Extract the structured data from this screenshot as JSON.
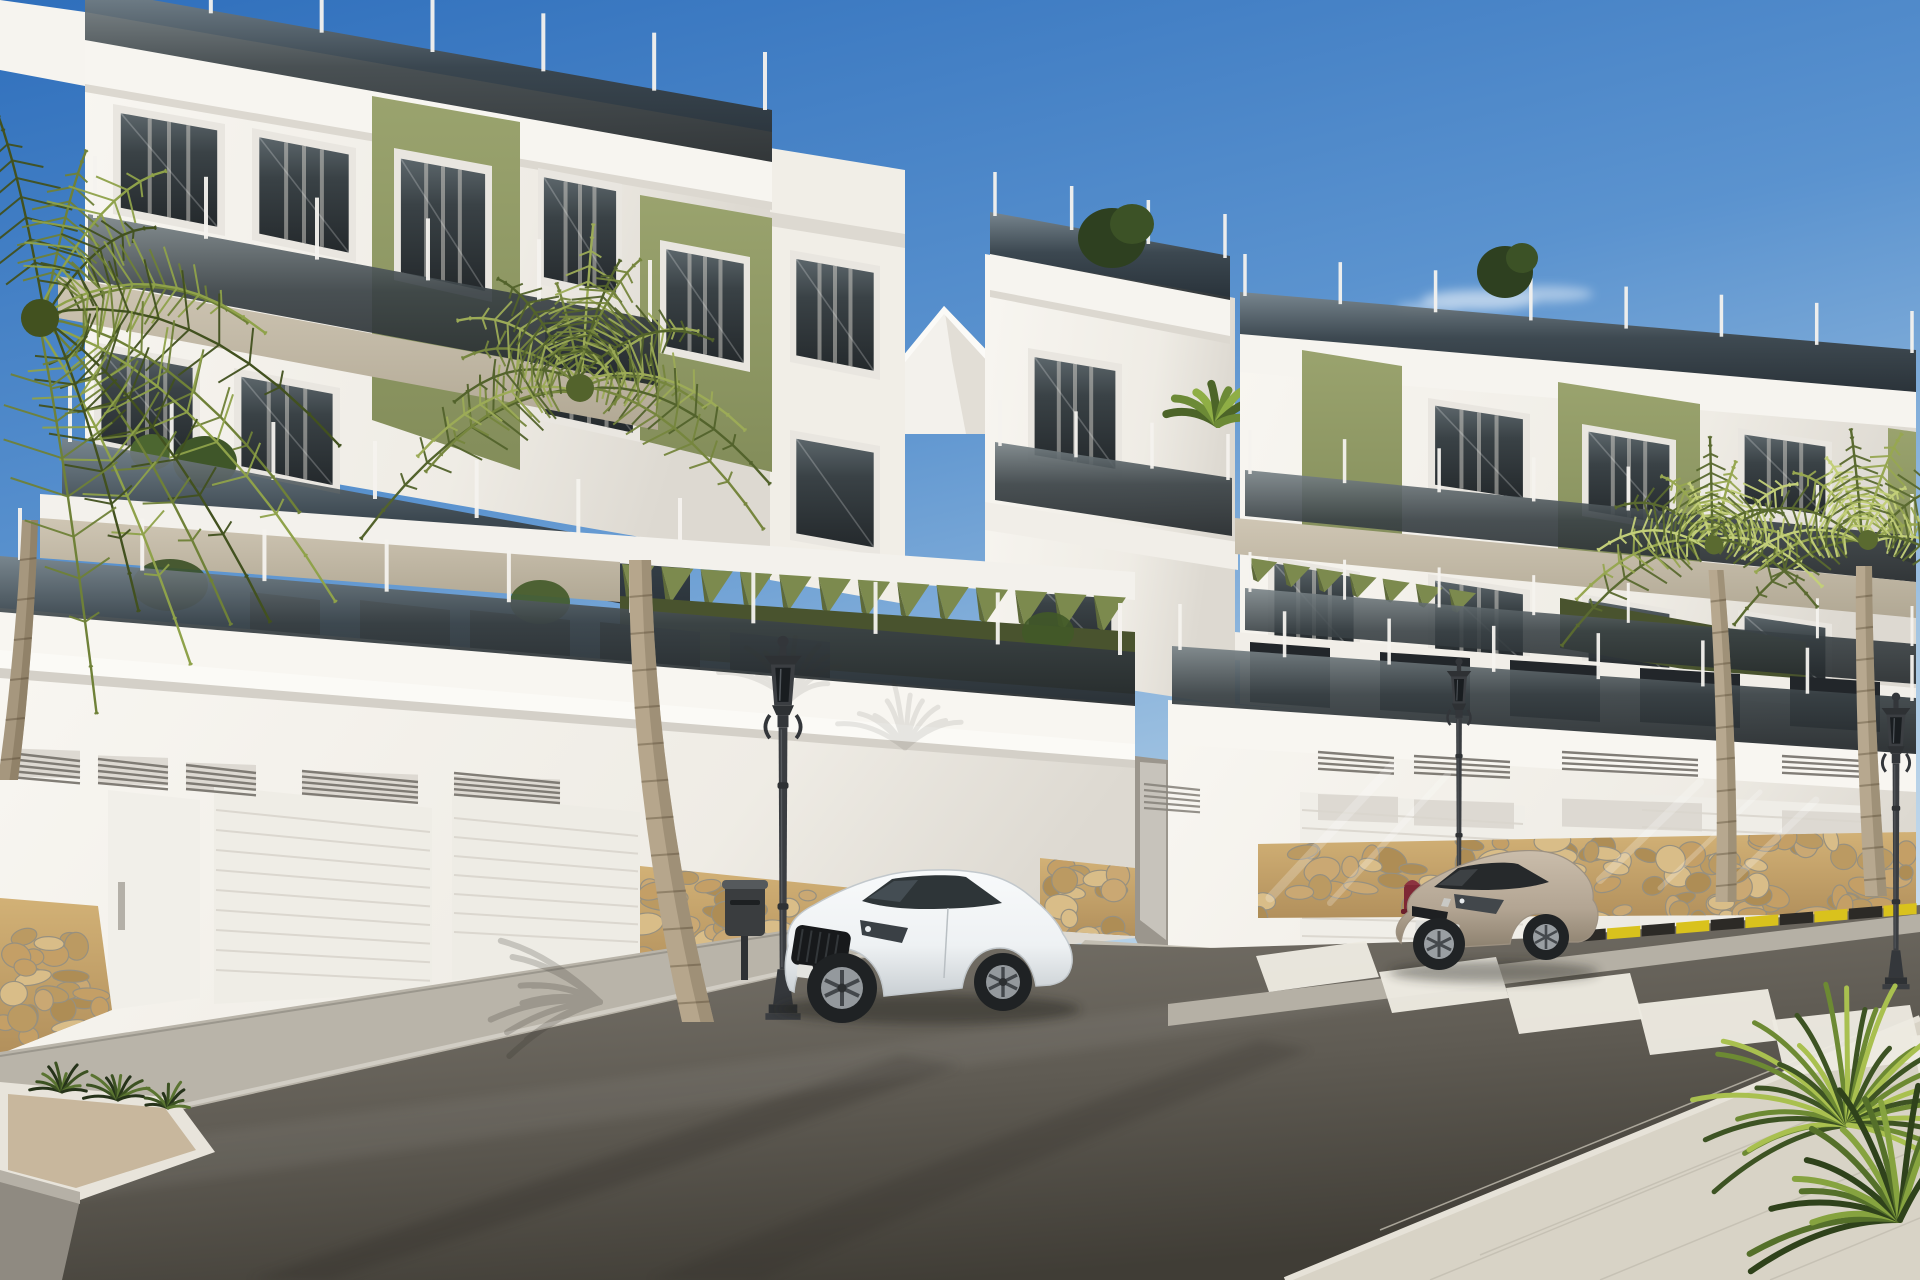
{
  "meta": {
    "scene_type": "photorealistic exterior architectural render",
    "subjects": [
      "modern apartment buildings",
      "white coupe car",
      "beige coupe car",
      "palm trees",
      "street with zebra crossing",
      "ornate street lamps",
      "fire hydrant",
      "garage doors",
      "stone base walls"
    ]
  },
  "palette": {
    "sky_top": "#2f6fbc",
    "sky_mid": "#5b93cf",
    "sky_low": "#a9c9e4",
    "sky_horizon": "#d2e2ef",
    "white_lit": "#f8f6f1",
    "white_mid": "#eceae3",
    "white_shade": "#d8d4cc",
    "taupe": "#cfc6b4",
    "taupe_dark": "#b1a894",
    "olive_lit": "#9aa36e",
    "olive": "#838d5a",
    "olive_dark": "#5f6a3c",
    "olive_deep": "#49532e",
    "glass_top": "#7b8589",
    "glass_mid": "#3a4246",
    "glass_dark": "#23282b",
    "asphalt_light": "#7d786f",
    "asphalt": "#5f5b53",
    "asphalt_dark": "#403d36",
    "sidewalk": "#b9b4a9",
    "pavers_corner": "#d8d3c6",
    "stone_bg": "#c8a76e",
    "mortar": "#97907f",
    "lamp_metal": "#35383b",
    "car_white": "#f5f7f8",
    "car_white_shade": "#c9cfd3",
    "car_beige": "#b9ab99",
    "car_beige_shade": "#8e8270",
    "hydrant_red": "#7e2835",
    "curb_yellow": "#d9c21d",
    "curb_black": "#2c2a26",
    "crosswalk_white": "#edeae1",
    "trunk": "#b6a68c",
    "trunk_shade": "#8c7d66",
    "green_dark": "#435426",
    "green_mid": "#6f8138",
    "green_lit": "#a8bb5c",
    "green_sun": "#cdd783"
  },
  "scene": {
    "windows": [
      {
        "l": "lyr-win-left",
        "pts": [
          [
            113,
            104
          ],
          [
            225,
            124
          ],
          [
            225,
            236
          ],
          [
            113,
            214
          ]
        ],
        "curt": true
      },
      {
        "l": "lyr-win-left",
        "pts": [
          [
            252,
            128
          ],
          [
            356,
            148
          ],
          [
            356,
            262
          ],
          [
            252,
            240
          ]
        ],
        "curt": true
      },
      {
        "l": "lyr-win-left",
        "pts": [
          [
            394,
            148
          ],
          [
            492,
            166
          ],
          [
            492,
            302
          ],
          [
            394,
            280
          ]
        ],
        "curt": true
      },
      {
        "l": "lyr-win-left",
        "pts": [
          [
            538,
            168
          ],
          [
            622,
            184
          ],
          [
            622,
            302
          ],
          [
            538,
            284
          ]
        ],
        "curt": true
      },
      {
        "l": "lyr-win-left",
        "pts": [
          [
            660,
            240
          ],
          [
            750,
            257
          ],
          [
            750,
            372
          ],
          [
            660,
            353
          ]
        ],
        "curt": true
      },
      {
        "l": "lyr-win-left",
        "pts": [
          [
            94,
            342
          ],
          [
            200,
            362
          ],
          [
            200,
            468
          ],
          [
            94,
            446
          ]
        ],
        "curt": true
      },
      {
        "l": "lyr-win-left",
        "pts": [
          [
            234,
            368
          ],
          [
            340,
            388
          ],
          [
            340,
            494
          ],
          [
            234,
            472
          ]
        ],
        "curt": true
      },
      {
        "l": "lyr-win-left",
        "pts": [
          [
            538,
            310
          ],
          [
            640,
            330
          ],
          [
            640,
            442
          ],
          [
            538,
            420
          ]
        ],
        "curt": true
      },
      {
        "l": "lyr-win-left",
        "pts": [
          [
            790,
            250
          ],
          [
            880,
            266
          ],
          [
            880,
            380
          ],
          [
            790,
            362
          ]
        ],
        "curt": true
      },
      {
        "l": "lyr-win-left",
        "pts": [
          [
            790,
            430
          ],
          [
            880,
            446
          ],
          [
            880,
            556
          ],
          [
            790,
            540
          ]
        ],
        "curt": false
      },
      {
        "l": "lyr-win-tower",
        "pts": [
          [
            1028,
            348
          ],
          [
            1122,
            364
          ],
          [
            1122,
            478
          ],
          [
            1028,
            462
          ]
        ],
        "curt": true
      },
      {
        "l": "lyr-win-tower",
        "pts": [
          [
            1022,
            568
          ],
          [
            1118,
            584
          ],
          [
            1118,
            664
          ],
          [
            1022,
            650
          ]
        ],
        "curt": false
      },
      {
        "l": "lyr-win-right",
        "pts": [
          [
            1428,
            398
          ],
          [
            1530,
            414
          ],
          [
            1530,
            506
          ],
          [
            1428,
            490
          ]
        ],
        "curt": true
      },
      {
        "l": "lyr-win-right",
        "pts": [
          [
            1582,
            424
          ],
          [
            1676,
            440
          ],
          [
            1676,
            532
          ],
          [
            1582,
            516
          ]
        ],
        "curt": true
      },
      {
        "l": "lyr-win-right",
        "pts": [
          [
            1738,
            428
          ],
          [
            1832,
            442
          ],
          [
            1832,
            522
          ],
          [
            1738,
            508
          ]
        ],
        "curt": true
      },
      {
        "l": "lyr-win-right",
        "pts": [
          [
            1268,
            556
          ],
          [
            1360,
            572
          ],
          [
            1360,
            660
          ],
          [
            1268,
            646
          ]
        ],
        "curt": true
      },
      {
        "l": "lyr-win-right",
        "pts": [
          [
            1428,
            574
          ],
          [
            1530,
            590
          ],
          [
            1530,
            668
          ],
          [
            1428,
            654
          ]
        ],
        "curt": true
      },
      {
        "l": "lyr-win-right",
        "pts": [
          [
            1582,
            594
          ],
          [
            1676,
            610
          ],
          [
            1676,
            682
          ],
          [
            1582,
            668
          ]
        ],
        "curt": false
      },
      {
        "l": "lyr-win-right",
        "pts": [
          [
            1738,
            610
          ],
          [
            1832,
            624
          ],
          [
            1832,
            692
          ],
          [
            1738,
            680
          ]
        ],
        "curt": false
      }
    ],
    "posts": [
      {
        "l": "lyr-p-roofL",
        "x0": 100,
        "y0": -6,
        "x1": 765,
        "y1": 110,
        "n": 7,
        "h": 58,
        "w": 4
      },
      {
        "l": "lyr-p-f3L",
        "x0": 95,
        "y0": 218,
        "x1": 650,
        "y1": 322,
        "n": 6,
        "h": 62,
        "w": 4
      },
      {
        "l": "lyr-p-f2L",
        "x0": 70,
        "y0": 442,
        "x1": 680,
        "y1": 556,
        "n": 7,
        "h": 58,
        "w": 4
      },
      {
        "l": "lyr-p-stL",
        "x0": 20,
        "y0": 560,
        "x1": 1120,
        "y1": 655,
        "n": 10,
        "h": 52,
        "w": 4
      },
      {
        "l": "lyr-p-twRoof",
        "x0": 995,
        "y0": 216,
        "x1": 1225,
        "y1": 258,
        "n": 4,
        "h": 44,
        "w": 3.5
      },
      {
        "l": "lyr-p-twBal",
        "x0": 1000,
        "y0": 446,
        "x1": 1228,
        "y1": 480,
        "n": 4,
        "h": 46,
        "w": 3.5
      },
      {
        "l": "lyr-p-rRoof",
        "x0": 1245,
        "y0": 296,
        "x1": 1912,
        "y1": 353,
        "n": 8,
        "h": 42,
        "w": 3.5
      },
      {
        "l": "lyr-p-rF3",
        "x0": 1250,
        "y0": 474,
        "x1": 1912,
        "y1": 538,
        "n": 8,
        "h": 44,
        "w": 3.5
      },
      {
        "l": "lyr-p-rF2",
        "x0": 1250,
        "y0": 592,
        "x1": 1912,
        "y1": 646,
        "n": 8,
        "h": 40,
        "w": 3
      },
      {
        "l": "lyr-p-stR",
        "x0": 1180,
        "y0": 650,
        "x1": 1912,
        "y1": 701,
        "n": 8,
        "h": 46,
        "w": 3.5
      }
    ],
    "louvers": [
      {
        "l": "lyr-louv-L",
        "x0": 622,
        "y0": 564,
        "x1": 1133,
        "y1": 598,
        "n": 13,
        "len": 36
      },
      {
        "l": "lyr-louv-R",
        "x0": 1250,
        "y0": 558,
        "x1": 1482,
        "y1": 594,
        "n": 7,
        "len": 24
      }
    ],
    "slats": [
      {
        "l": "lyr-slats-L",
        "x0": 216,
        "y0": 810,
        "x1": 430,
        "y1": 832,
        "n": 9,
        "sp": 20,
        "col": "#d9d5cd",
        "lw": 2
      },
      {
        "l": "lyr-slats-L",
        "x0": 454,
        "y0": 818,
        "x1": 638,
        "y1": 836,
        "n": 7,
        "sp": 19,
        "col": "#d9d5cd",
        "lw": 2
      },
      {
        "l": "lyr-slats-L",
        "x0": 10,
        "y0": 753,
        "x1": 80,
        "y1": 761,
        "n": 5,
        "sp": 6,
        "col": "#75716a",
        "lw": 2.4
      },
      {
        "l": "lyr-slats-L",
        "x0": 98,
        "y0": 759,
        "x1": 168,
        "y1": 767,
        "n": 5,
        "sp": 6,
        "col": "#75716a",
        "lw": 2.4
      },
      {
        "l": "lyr-slats-L",
        "x0": 186,
        "y0": 765,
        "x1": 256,
        "y1": 773,
        "n": 5,
        "sp": 6,
        "col": "#75716a",
        "lw": 2.4
      },
      {
        "l": "lyr-slats-L",
        "x0": 302,
        "y0": 771,
        "x1": 418,
        "y1": 782,
        "n": 5,
        "sp": 5.6,
        "col": "#75716a",
        "lw": 2.4
      },
      {
        "l": "lyr-slats-L",
        "x0": 454,
        "y0": 773,
        "x1": 560,
        "y1": 783,
        "n": 5,
        "sp": 5.4,
        "col": "#75716a",
        "lw": 2.4
      },
      {
        "l": "lyr-slats-R",
        "x0": 1302,
        "y0": 810,
        "x1": 1523,
        "y1": 824,
        "n": 8,
        "sp": 18,
        "col": "#dad6ce",
        "lw": 2
      },
      {
        "l": "lyr-slats-R",
        "x0": 1642,
        "y0": 810,
        "x1": 1866,
        "y1": 822,
        "n": 7,
        "sp": 17,
        "col": "#dad6ce",
        "lw": 2
      },
      {
        "l": "lyr-slats-R",
        "x0": 1318,
        "y0": 752,
        "x1": 1394,
        "y1": 758,
        "n": 4,
        "sp": 5.6,
        "col": "#75716a",
        "lw": 2.4
      },
      {
        "l": "lyr-slats-R",
        "x0": 1414,
        "y0": 756,
        "x1": 1510,
        "y1": 762,
        "n": 4,
        "sp": 5.6,
        "col": "#75716a",
        "lw": 2.4
      },
      {
        "l": "lyr-slats-R",
        "x0": 1562,
        "y0": 752,
        "x1": 1698,
        "y1": 760,
        "n": 4,
        "sp": 5.6,
        "col": "#75716a",
        "lw": 2.4
      },
      {
        "l": "lyr-slats-R",
        "x0": 1782,
        "y0": 756,
        "x1": 1878,
        "y1": 762,
        "n": 4,
        "sp": 5.6,
        "col": "#75716a",
        "lw": 2.4
      },
      {
        "l": "lyr-drive",
        "x0": 1144,
        "y0": 784,
        "x1": 1200,
        "y1": 790,
        "n": 5,
        "sp": 6,
        "col": "#8a867e",
        "lw": 2.2
      }
    ],
    "stones": [
      {
        "l": "lyr-stones-L",
        "clip": "clipSt1",
        "x0": 0,
        "y0": 905,
        "x1": 112,
        "y1": 960,
        "h": 120,
        "n": 30
      },
      {
        "l": "lyr-stones-L",
        "clip": "clipSt2",
        "x0": 640,
        "y0": 872,
        "x1": 930,
        "y1": 902,
        "h": 90,
        "n": 52
      },
      {
        "l": "lyr-stones-L",
        "clip": "clipSt3",
        "x0": 1040,
        "y0": 862,
        "x1": 1135,
        "y1": 876,
        "h": 72,
        "n": 18
      },
      {
        "l": "lyr-stones-R",
        "clip": "clipSt4",
        "x0": 1258,
        "y0": 846,
        "x1": 1916,
        "y1": 834,
        "h": 82,
        "n": 95
      }
    ],
    "stripes": {
      "l": "lyr-stripes",
      "x0": 1256,
      "y0": 946,
      "n": 6,
      "dx": 121,
      "dy": 16,
      "w": 110,
      "grow": 7,
      "h": 40,
      "hgrow": 5,
      "skew": 13,
      "tilt": 15
    },
    "curb": {
      "l": "lyr-curb",
      "x0": 1538,
      "y0": 934,
      "x1": 1918,
      "y1": 903,
      "blocks": 11,
      "h": 11
    },
    "palms": [
      {
        "l": "lyr-palms",
        "cx": 580,
        "cy": 388,
        "len": 200,
        "n": 17,
        "a0": -185,
        "a1": 5,
        "cols": [
          "#53632c",
          "#76863e",
          "#9cab57"
        ],
        "trunk": {
          "x0": 640,
          "y0": 560,
          "x1": 698,
          "y1": 1022,
          "w0": 22,
          "w1": 32,
          "bow": -26,
          "fill": "#b6a68c",
          "shade": "#8c7d66",
          "rings": 12
        }
      },
      {
        "l": "lyr-palms",
        "cx": 40,
        "cy": 318,
        "len": 272,
        "n": 14,
        "a0": -96,
        "a1": 84,
        "cols": [
          "#42511f",
          "#6f8138",
          "#8fa24a"
        ],
        "trunk": {
          "x0": 30,
          "y0": 520,
          "x1": 8,
          "y1": 780,
          "w0": 16,
          "w1": 20,
          "bow": 6,
          "fill": "#a6977e",
          "shade": "#7f7158",
          "rings": 6
        }
      },
      {
        "l": "lyr-palms",
        "cx": 1714,
        "cy": 545,
        "len": 135,
        "n": 13,
        "a0": -175,
        "a1": -5,
        "cols": [
          "#5a6a30",
          "#97a751",
          "#c3cf79"
        ],
        "trunk": {
          "x0": 1716,
          "y0": 570,
          "x1": 1726,
          "y1": 902,
          "w0": 15,
          "w1": 21,
          "bow": 8,
          "fill": "#b7a88f",
          "shade": "#8c7d66",
          "rings": 10
        }
      },
      {
        "l": "lyr-palms",
        "cx": 1868,
        "cy": 540,
        "len": 142,
        "n": 13,
        "a0": -175,
        "a1": -5,
        "cols": [
          "#5a6a30",
          "#97a751",
          "#c3cf79"
        ],
        "trunk": {
          "x0": 1864,
          "y0": 566,
          "x1": 1876,
          "y1": 896,
          "w0": 16,
          "w1": 22,
          "bow": -6,
          "fill": "#b7a88f",
          "shade": "#8c7d66",
          "rings": 10
        }
      }
    ],
    "flora": [
      {
        "l": "lyr-yucca",
        "cx": 1848,
        "cy": 1125,
        "n": 30,
        "len": 175,
        "a0": -200,
        "a1": 20,
        "cols": [
          "#3d5323",
          "#6d8a33",
          "#a9c04f"
        ],
        "lw": 5,
        "op": 1,
        "droop": 0.12
      },
      {
        "l": "lyr-yucca",
        "cx": 1900,
        "cy": 1220,
        "n": 16,
        "len": 150,
        "a0": -195,
        "a1": -60,
        "cols": [
          "#2f421b",
          "#55702a",
          "#86a33f"
        ],
        "lw": 6,
        "op": 1,
        "droop": 0.1
      },
      {
        "l": "lyr-planter",
        "cx": 62,
        "cy": 1092,
        "n": 10,
        "len": 34,
        "a0": -170,
        "a1": -10,
        "cols": [
          "#26331a",
          "#3c5222",
          "#5a7431"
        ],
        "lw": 3,
        "op": 1,
        "droop": 0.1
      },
      {
        "l": "lyr-planter",
        "cx": 118,
        "cy": 1100,
        "n": 10,
        "len": 38,
        "a0": -170,
        "a1": -10,
        "cols": [
          "#26331a",
          "#3c5222",
          "#5a7431"
        ],
        "lw": 3,
        "op": 1,
        "droop": 0.1
      },
      {
        "l": "lyr-planter",
        "cx": 168,
        "cy": 1108,
        "n": 9,
        "len": 30,
        "a0": -170,
        "a1": -10,
        "cols": [
          "#26331a",
          "#3c5222",
          "#5a7431"
        ],
        "lw": 3,
        "op": 1,
        "droop": 0.1
      },
      {
        "l": "lyr-banana",
        "cx": 1218,
        "cy": 424,
        "n": 8,
        "len": 62,
        "a0": -160,
        "a1": -20,
        "cols": [
          "#4c6428",
          "#6c8a36",
          "#8fae45"
        ],
        "lw": 8,
        "op": 1,
        "droop": 0.2
      },
      {
        "l": "lyr-shadow-L",
        "cx": 790,
        "cy": 700,
        "n": 10,
        "len": 80,
        "a0": -150,
        "a1": -30,
        "cols": [
          "#3a382f",
          "#3a382f",
          "#3a382f"
        ],
        "lw": 5,
        "op": 0.1,
        "droop": 0.15
      },
      {
        "l": "lyr-shadow-L",
        "cx": 905,
        "cy": 748,
        "n": 10,
        "len": 88,
        "a0": -150,
        "a1": -30,
        "cols": [
          "#3a382f",
          "#3a382f",
          "#3a382f"
        ],
        "lw": 5,
        "op": 0.1,
        "droop": 0.15
      },
      {
        "l": "lyr-shadow-road",
        "cx": 600,
        "cy": 1002,
        "n": 9,
        "len": 120,
        "a0": 150,
        "a1": 215,
        "cols": [
          "#2b2922",
          "#2b2922",
          "#2b2922"
        ],
        "lw": 6,
        "op": 0.2,
        "droop": 0.05
      }
    ]
  }
}
